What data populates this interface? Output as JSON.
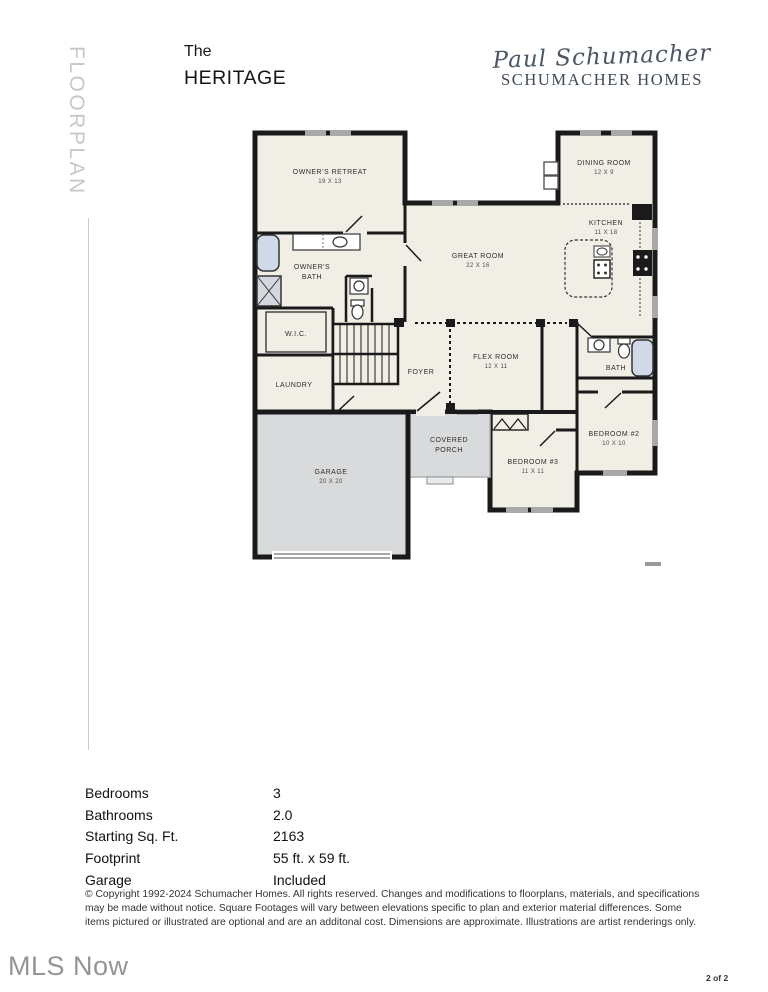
{
  "sidebar_label": "FLOORPLAN",
  "header": {
    "title_line1": "The",
    "title_line2": "HERITAGE",
    "logo_script": "Paul Schumacher",
    "logo_wordmark": "SCHUMACHER HOMES"
  },
  "floorplan": {
    "rooms": [
      {
        "id": "owners-retreat",
        "lines": [
          "OWNER'S RETREAT",
          "19 X 13"
        ]
      },
      {
        "id": "great-room",
        "lines": [
          "GREAT ROOM",
          "22 X 16"
        ]
      },
      {
        "id": "dining-room",
        "lines": [
          "DINING ROOM",
          "12 X 9"
        ]
      },
      {
        "id": "kitchen",
        "lines": [
          "KITCHEN",
          "11 X 18"
        ]
      },
      {
        "id": "owners-bath",
        "lines": [
          "OWNER'S",
          "BATH"
        ]
      },
      {
        "id": "wic",
        "lines": [
          "W.I.C."
        ]
      },
      {
        "id": "laundry",
        "lines": [
          "LAUNDRY"
        ]
      },
      {
        "id": "foyer",
        "lines": [
          "FOYER"
        ]
      },
      {
        "id": "flex-room",
        "lines": [
          "FLEX ROOM",
          "12 X 11"
        ]
      },
      {
        "id": "bath",
        "lines": [
          "BATH"
        ]
      },
      {
        "id": "bedroom-2",
        "lines": [
          "BEDROOM #2",
          "10 X 10"
        ]
      },
      {
        "id": "bedroom-3",
        "lines": [
          "BEDROOM #3",
          "11 X 11"
        ]
      },
      {
        "id": "garage",
        "lines": [
          "GARAGE",
          "20 X 20"
        ]
      },
      {
        "id": "covered-porch",
        "lines": [
          "COVERED",
          "PORCH"
        ]
      }
    ],
    "colors": {
      "wall": "#1a1a1a",
      "room_fill": "#f1efe5",
      "garage_fill": "#d8dadc",
      "tub_fill": "#cfd9e7",
      "window_marker": "#a9a9a9",
      "logo_color": "#4b5765"
    }
  },
  "specs": {
    "rows": [
      {
        "label": "Bedrooms",
        "value": "3"
      },
      {
        "label": "Bathrooms",
        "value": "2.0"
      },
      {
        "label": "Starting Sq. Ft.",
        "value": "2163"
      },
      {
        "label": "Footprint",
        "value": "55 ft. x 59 ft."
      },
      {
        "label": "Garage",
        "value": "Included"
      }
    ]
  },
  "disclaimer": "© Copyright 1992-2024 Schumacher Homes. All rights reserved. Changes and modifications to floorplans, materials, and specifications may be made without notice. Square Footages will vary between elevations specific to plan and exterior material differences. Some items pictured or illustrated are optional and are an additonal cost. Dimensions are approximate. Illustrations are artist renderings only.",
  "footer": {
    "watermark": "MLS Now",
    "page_indicator": "2 of 2"
  }
}
